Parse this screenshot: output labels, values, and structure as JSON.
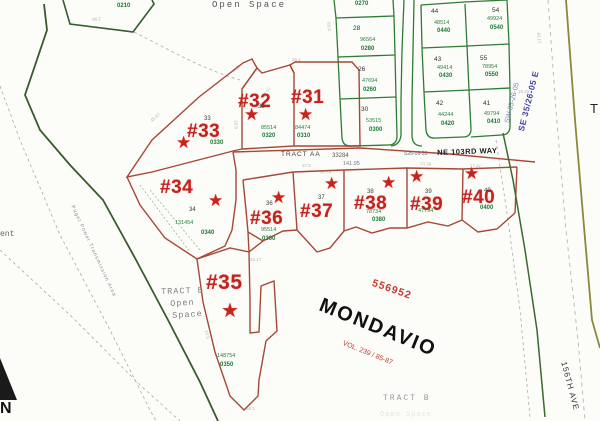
{
  "map": {
    "plat_name": "MONDAVIO",
    "plat_number": "556952",
    "volume_ref": "VOL. 239 / 85-87",
    "open_space_top": "Open Space",
    "icons": {
      "star": "★"
    },
    "streets": {
      "ne_103rd_way": "NE 103RD WAY",
      "ne_103rd_prefix": "S26-16-33",
      "ave_156th": "156TH AVE"
    },
    "section_labels": {
      "se": "SE 35/26-05 E",
      "sw": "SW 35-26-05",
      "right_edge_partial": "T"
    },
    "tract_aa": {
      "name": "TRACT AA",
      "number": "33284",
      "dim": "141.95"
    },
    "tract_b_left": {
      "line1": "TRACT B",
      "line2": "Open",
      "line3": "Space"
    },
    "tract_b_bottom": {
      "line1": "TRACT B",
      "line2": "Open Space"
    },
    "ngpa": "Puget Power Transmission Area",
    "left_edge_partial": "ent",
    "north_partial": "N",
    "partial_parcels": {
      "p0270": "0270",
      "p0210": "0210"
    },
    "marked_lots": [
      {
        "label": "#31",
        "area": "84474",
        "parcel": "0310"
      },
      {
        "label": "#32",
        "lot_no": "32",
        "area": "85514",
        "parcel": "0320"
      },
      {
        "label": "#33",
        "lot_no": "33",
        "parcel": "0330"
      },
      {
        "label": "#34",
        "lot_no": "34",
        "area": "131454",
        "parcel": "0340"
      },
      {
        "label": "#35",
        "area": "148754",
        "parcel": "0350"
      },
      {
        "label": "#36",
        "lot_no": "36",
        "area": "95514",
        "parcel": "0360"
      },
      {
        "label": "#37",
        "lot_no": "37"
      },
      {
        "label": "#38",
        "lot_no": "38",
        "area": "78734",
        "parcel": "0380"
      },
      {
        "label": "#39",
        "lot_no": "39",
        "area": "47794"
      },
      {
        "label": "#40",
        "lot_no": "40",
        "parcel": "0400"
      }
    ],
    "grid_lots": [
      {
        "no": "28",
        "area": "96564",
        "parcel": "0280"
      },
      {
        "no": "26",
        "area": "47694",
        "parcel": "0260"
      },
      {
        "no": "30",
        "area": "53515",
        "parcel": "0300"
      },
      {
        "no": "44",
        "area": "48514",
        "parcel": "0440"
      },
      {
        "no": "43",
        "area": "49414",
        "parcel": "0430"
      },
      {
        "no": "42",
        "area": "44244",
        "parcel": "0420"
      },
      {
        "no": "54",
        "area": "49924",
        "parcel": "0540"
      },
      {
        "no": "55",
        "area": "78954",
        "parcel": "0550"
      },
      {
        "no": "41",
        "area": "49794",
        "parcel": "0410"
      }
    ],
    "colors": {
      "lot_label_red": "#c6221c",
      "parcel_line_red": "#a03826",
      "grid_green": "#2f7c35",
      "green_text": "#1d7a35",
      "road_olive": "#8a8a3a",
      "boundary_dark_green": "#3a5a2c",
      "section_blue": "#4343ae"
    },
    "dims": [
      {
        "t": "96.2",
        "x": 92,
        "y": 18,
        "r": -6
      },
      {
        "t": "4.32",
        "x": 232,
        "y": 70,
        "r": -38
      },
      {
        "t": "25.1",
        "x": 292,
        "y": 58,
        "r": 0
      },
      {
        "t": "13.07",
        "x": 262,
        "y": 96,
        "r": -52
      },
      {
        "t": "45.67",
        "x": 150,
        "y": 120,
        "r": -40
      },
      {
        "t": "65.0",
        "x": 330,
        "y": 22,
        "r": 82
      },
      {
        "t": "37.5",
        "x": 302,
        "y": 164,
        "r": 0
      },
      {
        "t": "12.74",
        "x": 320,
        "y": 170,
        "r": 4
      },
      {
        "t": "13.39",
        "x": 420,
        "y": 162,
        "r": 4
      },
      {
        "t": "17.41",
        "x": 470,
        "y": 164,
        "r": 4
      },
      {
        "t": "40.17",
        "x": 540,
        "y": 32,
        "r": 84
      },
      {
        "t": "29.9",
        "x": 237,
        "y": 120,
        "r": 84
      },
      {
        "t": "16.32",
        "x": 518,
        "y": 90,
        "r": 0
      },
      {
        "t": "45.17",
        "x": 250,
        "y": 258,
        "r": 0
      },
      {
        "t": "14.5",
        "x": 208,
        "y": 330,
        "r": 80
      },
      {
        "t": "58.1",
        "x": 246,
        "y": 407,
        "r": 0
      }
    ]
  }
}
